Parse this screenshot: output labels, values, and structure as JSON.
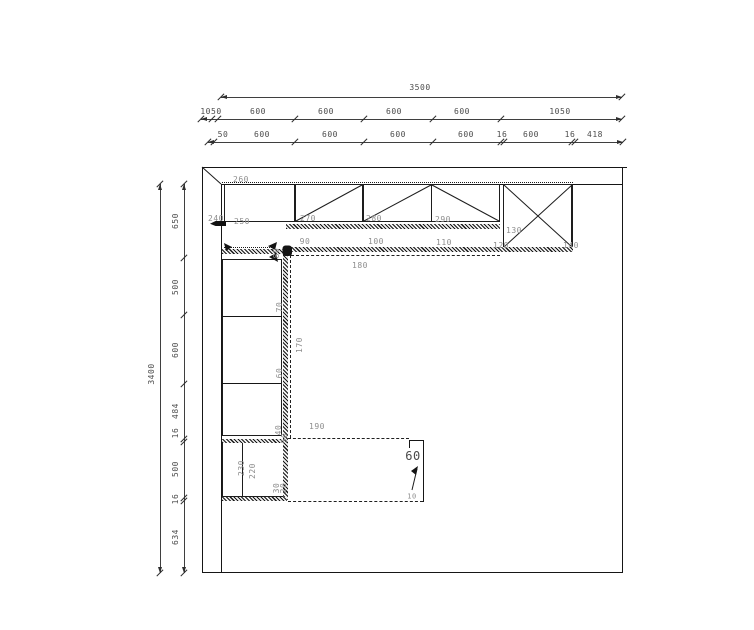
{
  "drawing": {
    "type": "kitchen floor plan, top view",
    "room": {
      "width_mm": "3500",
      "depth_mm": "3400"
    }
  },
  "dimensions": {
    "top_overall": "3500",
    "top_row2": [
      "1050",
      "600",
      "600",
      "600",
      "600",
      "1050"
    ],
    "top_row3": [
      "50",
      "600",
      "600",
      "600",
      "600",
      "16",
      "600",
      "16",
      "418"
    ],
    "left_overall": "3400",
    "left_chain": [
      "650",
      "500",
      "600",
      "484",
      "16",
      "500",
      "16",
      "634"
    ]
  },
  "item_numbers": {
    "wall_units": [
      "240",
      "250",
      "260",
      "270",
      "280",
      "290"
    ],
    "base_units": [
      "90",
      "100",
      "110"
    ],
    "tall_unit": [
      "120",
      "130",
      "140"
    ],
    "left_run_units": [
      "80",
      "70",
      "60",
      "40"
    ],
    "lower_run_units": [
      "50",
      "30",
      "20",
      "230",
      "220"
    ],
    "worktops": [
      "170",
      "180",
      "190"
    ],
    "callout": {
      "label": "60",
      "secondary": "10"
    }
  },
  "labels": {
    "d3500": "3500",
    "dA1": "1050",
    "dA2": "600",
    "dA3": "600",
    "dA4": "600",
    "dA5": "600",
    "dA6": "1050",
    "dB1": "50",
    "dB2": "600",
    "dB3": "600",
    "dB4": "600",
    "dB5": "600",
    "dB6": "16",
    "dB7": "600",
    "dB8": "16",
    "dB9": "418",
    "d3400": "3400",
    "dL1": "650",
    "dL2": "500",
    "dL3": "600",
    "dL4": "484",
    "dL5": "16",
    "dL6": "500",
    "dL7": "16",
    "dL8": "634",
    "i260": "260",
    "i240": "240",
    "i250": "250",
    "i270": "270",
    "i280": "280",
    "i290": "290",
    "i90": "90",
    "i100": "100",
    "i110": "110",
    "i130": "130",
    "i120": "120",
    "i140": "140",
    "i180": "180",
    "i80": "80",
    "i70": "70",
    "i60": "60",
    "i40": "40",
    "i50": "50",
    "i170": "170",
    "i190": "190",
    "i230": "230",
    "i220": "220",
    "i30": "30",
    "i20": "20",
    "i10": "10",
    "c60": "60"
  },
  "colors": {
    "background": "#ffffff",
    "wall_line": "#161616",
    "dimension_line": "#3f3f3f",
    "dimension_text": "#4c4c4c",
    "item_text": "#8e8e8e"
  }
}
